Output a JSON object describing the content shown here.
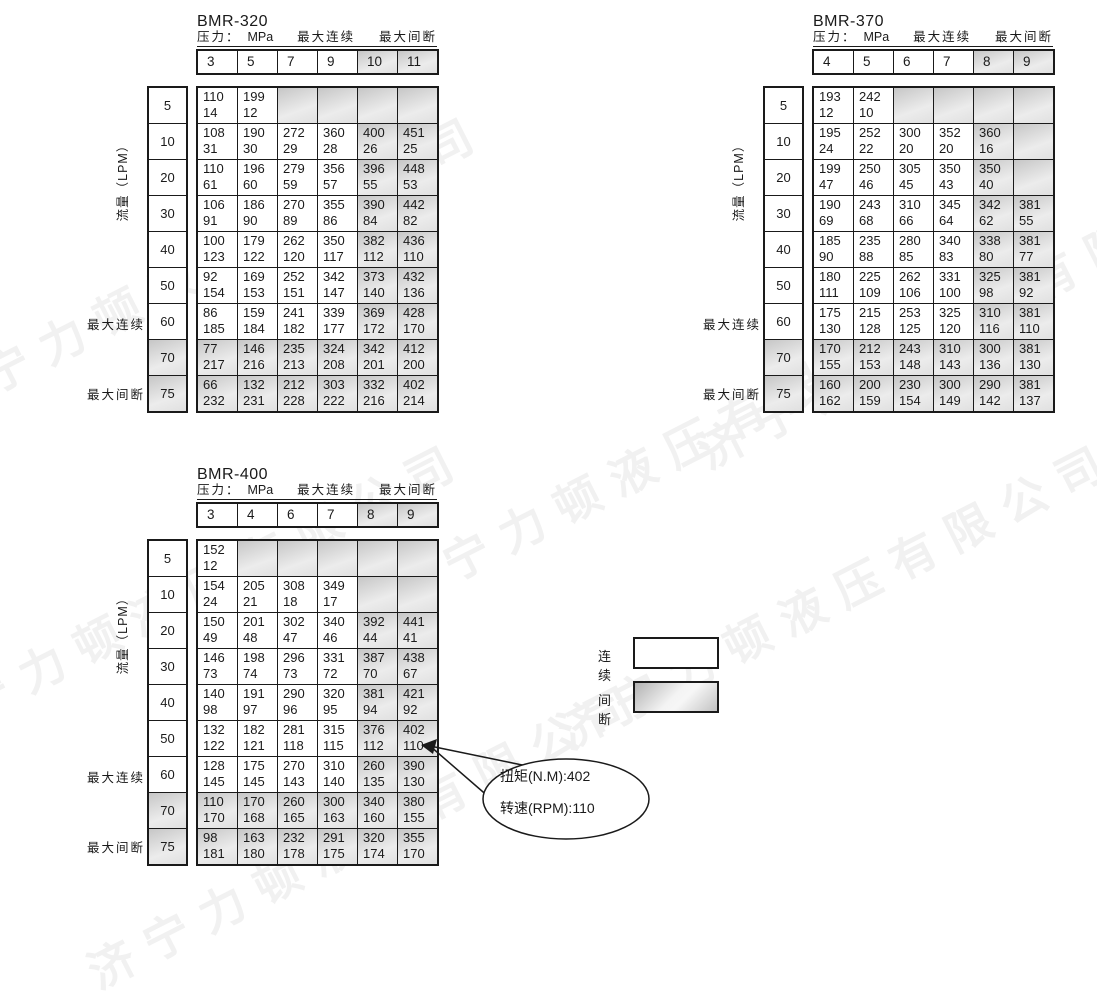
{
  "watermark": {
    "text": "济宁力顿液压有限公司"
  },
  "shared_labels": {
    "pressure_prefix": "压力：",
    "pressure_unit": "MPa",
    "max_continuous": "最大连续",
    "max_intermittent": "最大间断",
    "flow_axis": "流量（LPM）"
  },
  "cell_value_order": [
    "torque_nm",
    "speed_rpm"
  ],
  "legend": {
    "continuous": "连续",
    "intermittent": "间断"
  },
  "callout": {
    "torque_line": "扭矩(N.M):402",
    "speed_line": "转速(RPM):110"
  },
  "tables": [
    {
      "title": "BMR-320",
      "columns": [
        {
          "label": "3",
          "shaded": false
        },
        {
          "label": "5",
          "shaded": false
        },
        {
          "label": "7",
          "shaded": false
        },
        {
          "label": "9",
          "shaded": false
        },
        {
          "label": "10",
          "shaded": true
        },
        {
          "label": "11",
          "shaded": true
        }
      ],
      "rows": [
        {
          "flow": "5",
          "shaded": false,
          "cells": [
            [
              "110",
              "14"
            ],
            [
              "199",
              "12"
            ],
            null,
            null,
            null,
            null
          ]
        },
        {
          "flow": "10",
          "shaded": false,
          "cells": [
            [
              "108",
              "31"
            ],
            [
              "190",
              "30"
            ],
            [
              "272",
              "29"
            ],
            [
              "360",
              "28"
            ],
            [
              "400",
              "26"
            ],
            [
              "451",
              "25"
            ]
          ]
        },
        {
          "flow": "20",
          "shaded": false,
          "cells": [
            [
              "110",
              "61"
            ],
            [
              "196",
              "60"
            ],
            [
              "279",
              "59"
            ],
            [
              "356",
              "57"
            ],
            [
              "396",
              "55"
            ],
            [
              "448",
              "53"
            ]
          ]
        },
        {
          "flow": "30",
          "shaded": false,
          "cells": [
            [
              "106",
              "91"
            ],
            [
              "186",
              "90"
            ],
            [
              "270",
              "89"
            ],
            [
              "355",
              "86"
            ],
            [
              "390",
              "84"
            ],
            [
              "442",
              "82"
            ]
          ]
        },
        {
          "flow": "40",
          "shaded": false,
          "cells": [
            [
              "100",
              "123"
            ],
            [
              "179",
              "122"
            ],
            [
              "262",
              "120"
            ],
            [
              "350",
              "117"
            ],
            [
              "382",
              "112"
            ],
            [
              "436",
              "110"
            ]
          ]
        },
        {
          "flow": "50",
          "shaded": false,
          "cells": [
            [
              "92",
              "154"
            ],
            [
              "169",
              "153"
            ],
            [
              "252",
              "151"
            ],
            [
              "342",
              "147"
            ],
            [
              "373",
              "140"
            ],
            [
              "432",
              "136"
            ]
          ]
        },
        {
          "flow": "60",
          "shaded": false,
          "cells": [
            [
              "86",
              "185"
            ],
            [
              "159",
              "184"
            ],
            [
              "241",
              "182"
            ],
            [
              "339",
              "177"
            ],
            [
              "369",
              "172"
            ],
            [
              "428",
              "170"
            ]
          ]
        },
        {
          "flow": "70",
          "shaded": true,
          "cells": [
            [
              "77",
              "217"
            ],
            [
              "146",
              "216"
            ],
            [
              "235",
              "213"
            ],
            [
              "324",
              "208"
            ],
            [
              "342",
              "201"
            ],
            [
              "412",
              "200"
            ]
          ]
        },
        {
          "flow": "75",
          "shaded": true,
          "cells": [
            [
              "66",
              "232"
            ],
            [
              "132",
              "231"
            ],
            [
              "212",
              "228"
            ],
            [
              "303",
              "222"
            ],
            [
              "332",
              "216"
            ],
            [
              "402",
              "214"
            ]
          ]
        }
      ]
    },
    {
      "title": "BMR-370",
      "columns": [
        {
          "label": "4",
          "shaded": false
        },
        {
          "label": "5",
          "shaded": false
        },
        {
          "label": "6",
          "shaded": false
        },
        {
          "label": "7",
          "shaded": false
        },
        {
          "label": "8",
          "shaded": true
        },
        {
          "label": "9",
          "shaded": true
        }
      ],
      "rows": [
        {
          "flow": "5",
          "shaded": false,
          "cells": [
            [
              "193",
              "12"
            ],
            [
              "242",
              "10"
            ],
            null,
            null,
            null,
            null
          ]
        },
        {
          "flow": "10",
          "shaded": false,
          "cells": [
            [
              "195",
              "24"
            ],
            [
              "252",
              "22"
            ],
            [
              "300",
              "20"
            ],
            [
              "352",
              "20"
            ],
            [
              "360",
              "16"
            ],
            null
          ]
        },
        {
          "flow": "20",
          "shaded": false,
          "cells": [
            [
              "199",
              "47"
            ],
            [
              "250",
              "46"
            ],
            [
              "305",
              "45"
            ],
            [
              "350",
              "43"
            ],
            [
              "350",
              "40"
            ],
            null
          ]
        },
        {
          "flow": "30",
          "shaded": false,
          "cells": [
            [
              "190",
              "69"
            ],
            [
              "243",
              "68"
            ],
            [
              "310",
              "66"
            ],
            [
              "345",
              "64"
            ],
            [
              "342",
              "62"
            ],
            [
              "381",
              "55"
            ]
          ]
        },
        {
          "flow": "40",
          "shaded": false,
          "cells": [
            [
              "185",
              "90"
            ],
            [
              "235",
              "88"
            ],
            [
              "280",
              "85"
            ],
            [
              "340",
              "83"
            ],
            [
              "338",
              "80"
            ],
            [
              "381",
              "77"
            ]
          ]
        },
        {
          "flow": "50",
          "shaded": false,
          "cells": [
            [
              "180",
              "111"
            ],
            [
              "225",
              "109"
            ],
            [
              "262",
              "106"
            ],
            [
              "331",
              "100"
            ],
            [
              "325",
              "98"
            ],
            [
              "381",
              "92"
            ]
          ]
        },
        {
          "flow": "60",
          "shaded": false,
          "cells": [
            [
              "175",
              "130"
            ],
            [
              "215",
              "128"
            ],
            [
              "253",
              "125"
            ],
            [
              "325",
              "120"
            ],
            [
              "310",
              "116"
            ],
            [
              "381",
              "110"
            ]
          ]
        },
        {
          "flow": "70",
          "shaded": true,
          "cells": [
            [
              "170",
              "155"
            ],
            [
              "212",
              "153"
            ],
            [
              "243",
              "148"
            ],
            [
              "310",
              "143"
            ],
            [
              "300",
              "136"
            ],
            [
              "381",
              "130"
            ]
          ]
        },
        {
          "flow": "75",
          "shaded": true,
          "cells": [
            [
              "160",
              "162"
            ],
            [
              "200",
              "159"
            ],
            [
              "230",
              "154"
            ],
            [
              "300",
              "149"
            ],
            [
              "290",
              "142"
            ],
            [
              "381",
              "137"
            ]
          ]
        }
      ]
    },
    {
      "title": "BMR-400",
      "columns": [
        {
          "label": "3",
          "shaded": false
        },
        {
          "label": "4",
          "shaded": false
        },
        {
          "label": "6",
          "shaded": false
        },
        {
          "label": "7",
          "shaded": false
        },
        {
          "label": "8",
          "shaded": true
        },
        {
          "label": "9",
          "shaded": true
        }
      ],
      "rows": [
        {
          "flow": "5",
          "shaded": false,
          "cells": [
            [
              "152",
              "12"
            ],
            null,
            null,
            null,
            null,
            null
          ]
        },
        {
          "flow": "10",
          "shaded": false,
          "cells": [
            [
              "154",
              "24"
            ],
            [
              "205",
              "21"
            ],
            [
              "308",
              "18"
            ],
            [
              "349",
              "17"
            ],
            null,
            null
          ]
        },
        {
          "flow": "20",
          "shaded": false,
          "cells": [
            [
              "150",
              "49"
            ],
            [
              "201",
              "48"
            ],
            [
              "302",
              "47"
            ],
            [
              "340",
              "46"
            ],
            [
              "392",
              "44"
            ],
            [
              "441",
              "41"
            ]
          ]
        },
        {
          "flow": "30",
          "shaded": false,
          "cells": [
            [
              "146",
              "73"
            ],
            [
              "198",
              "74"
            ],
            [
              "296",
              "73"
            ],
            [
              "331",
              "72"
            ],
            [
              "387",
              "70"
            ],
            [
              "438",
              "67"
            ]
          ]
        },
        {
          "flow": "40",
          "shaded": false,
          "cells": [
            [
              "140",
              "98"
            ],
            [
              "191",
              "97"
            ],
            [
              "290",
              "96"
            ],
            [
              "320",
              "95"
            ],
            [
              "381",
              "94"
            ],
            [
              "421",
              "92"
            ]
          ]
        },
        {
          "flow": "50",
          "shaded": false,
          "cells": [
            [
              "132",
              "122"
            ],
            [
              "182",
              "121"
            ],
            [
              "281",
              "118"
            ],
            [
              "315",
              "115"
            ],
            [
              "376",
              "112"
            ],
            [
              "402",
              "110"
            ]
          ]
        },
        {
          "flow": "60",
          "shaded": false,
          "cells": [
            [
              "128",
              "145"
            ],
            [
              "175",
              "145"
            ],
            [
              "270",
              "143"
            ],
            [
              "310",
              "140"
            ],
            [
              "260",
              "135"
            ],
            [
              "390",
              "130"
            ]
          ]
        },
        {
          "flow": "70",
          "shaded": true,
          "cells": [
            [
              "110",
              "170"
            ],
            [
              "170",
              "168"
            ],
            [
              "260",
              "165"
            ],
            [
              "300",
              "163"
            ],
            [
              "340",
              "160"
            ],
            [
              "380",
              "155"
            ]
          ]
        },
        {
          "flow": "75",
          "shaded": true,
          "cells": [
            [
              "98",
              "181"
            ],
            [
              "163",
              "180"
            ],
            [
              "232",
              "178"
            ],
            [
              "291",
              "175"
            ],
            [
              "320",
              "174"
            ],
            [
              "355",
              "170"
            ]
          ]
        }
      ]
    }
  ]
}
